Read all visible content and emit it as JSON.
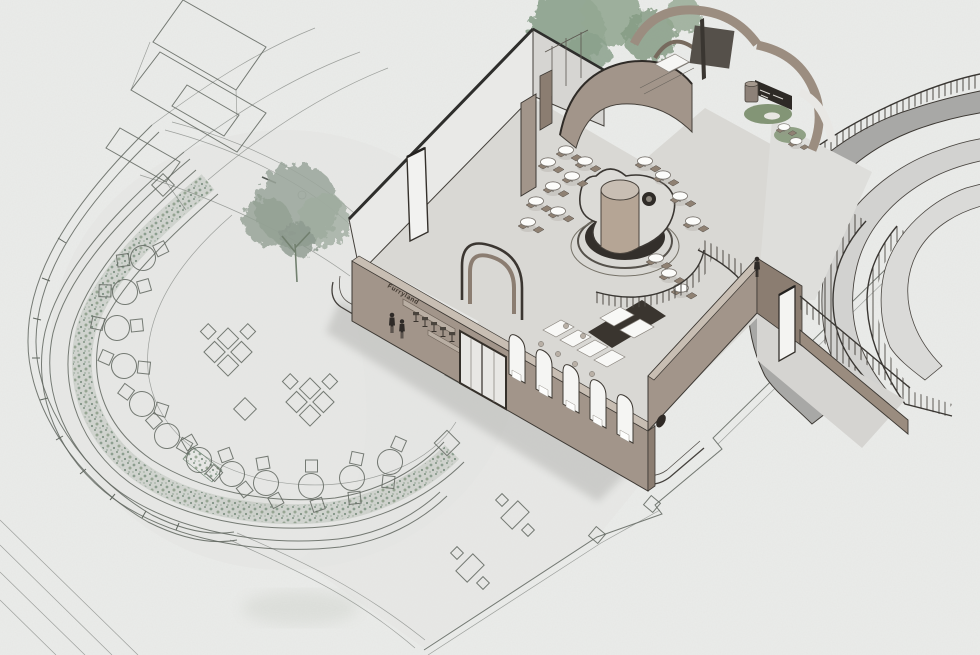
{
  "illustration": {
    "title": "cafe-axonometric-site-illustration",
    "sign_text": "Furryland",
    "palette": {
      "paper": "#ebecea",
      "plan_line": "#60665f",
      "planting_green": "#7c9180",
      "tree_green": "#97a59a",
      "moss_green": "#7d9070",
      "wall_face": "#a2958a",
      "wall_dark": "#8b7d71",
      "wall_top": "#c8beb3",
      "white_wall": "#e9e9e7",
      "floor": "#d9d8d4",
      "dark_accent": "#332f2b",
      "ramp_band": "#a8a8a6",
      "ramp_light": "#d2d2d0",
      "table_white": "#f8f8f6",
      "figure": "#2e2a27"
    }
  }
}
